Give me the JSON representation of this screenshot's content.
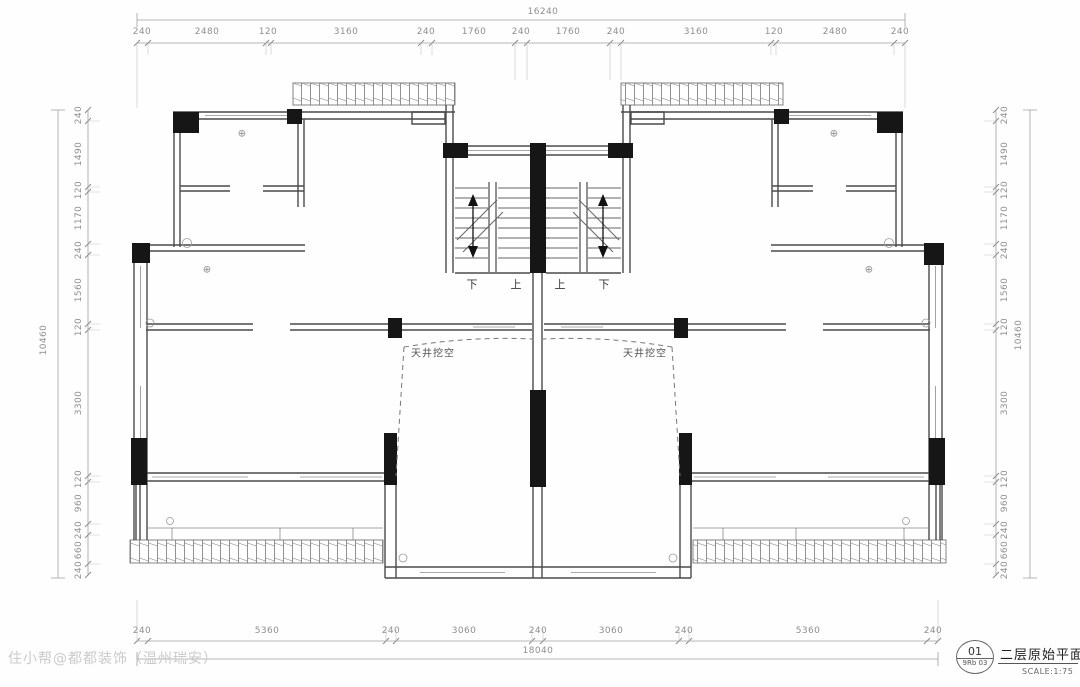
{
  "drawing": {
    "title": "二层原始平面图",
    "scale": "SCALE:1:75",
    "sheet_number": "01",
    "sheet_ref": "9Rb 03",
    "watermark": "住小帮@都都装饰（温州瑞安）"
  },
  "plan": {
    "stair_labels": [
      "下",
      "上",
      "上",
      "下"
    ],
    "void_label_left": "天井挖空",
    "void_label_right": "天井挖空",
    "center_symbol": "⊕"
  },
  "dims": {
    "top": {
      "overall": "16240",
      "segments": [
        "240",
        "2480",
        "120",
        "3160",
        "240",
        "1760",
        "240",
        "1760",
        "240",
        "3160",
        "120",
        "2480",
        "240"
      ]
    },
    "bottom": {
      "overall": "18040",
      "segments": [
        "240",
        "5360",
        "240",
        "3060",
        "240",
        "3060",
        "240",
        "5360",
        "240"
      ]
    },
    "left": {
      "overall": "10460",
      "segments": [
        "240",
        "1490",
        "120",
        "1170",
        "240",
        "1560",
        "120",
        "3300",
        "120",
        "960",
        "240",
        "660",
        "240"
      ]
    },
    "right": {
      "overall": "10460",
      "segments": [
        "240",
        "1490",
        "120",
        "1170",
        "240",
        "1560",
        "120",
        "3300",
        "120",
        "960",
        "240",
        "660",
        "240"
      ]
    }
  }
}
